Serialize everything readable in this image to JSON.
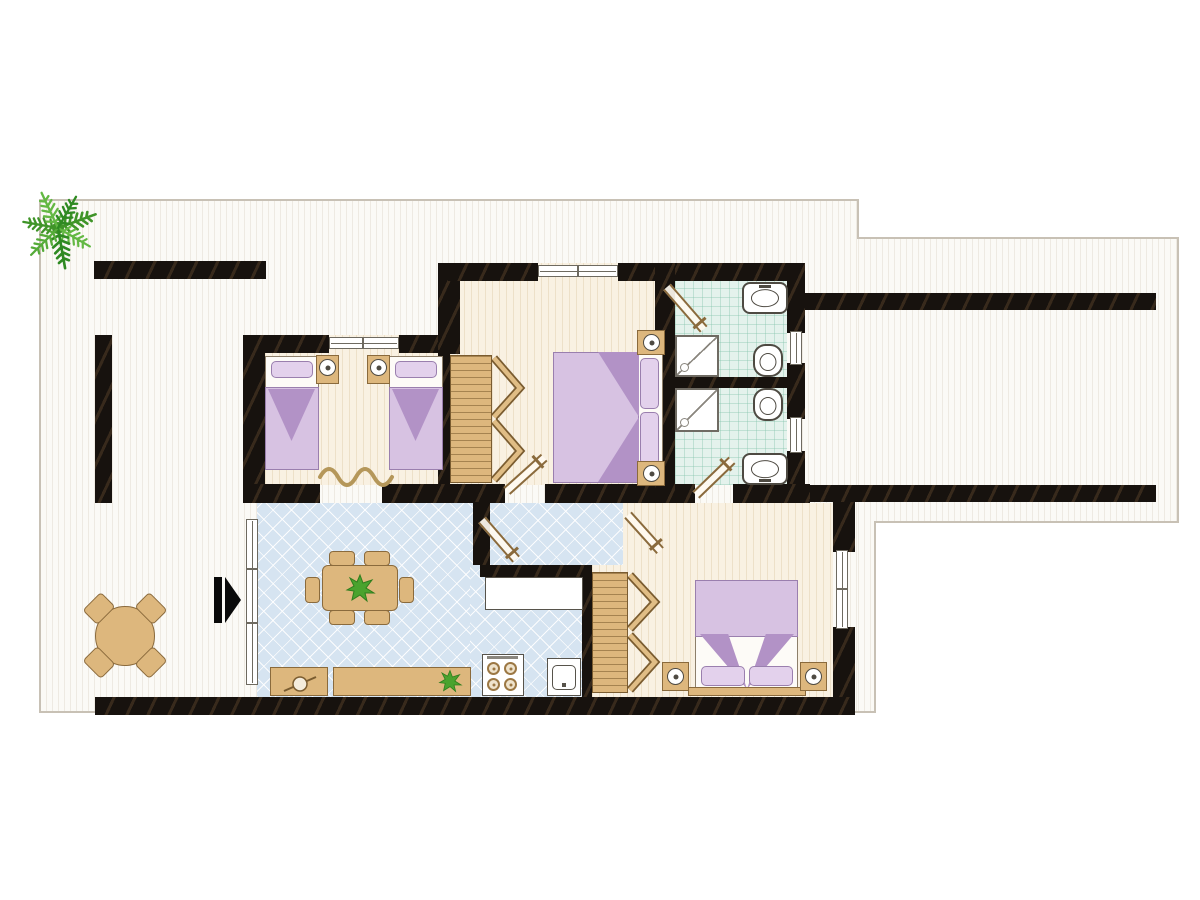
{
  "document": {
    "kind": "apartment floor plan drawing",
    "visible_text": "none",
    "orientation": "top-down plan view"
  },
  "colors": {
    "wall": "#17120e",
    "boundary_line": "#c8c1b5",
    "terrace_floor": "#fbfaf6",
    "bedroom_floor": "#f9f1e2",
    "living_floor": "#d6e4f1",
    "bath_floor": "#e4f2ec",
    "wood": "#ddb77d",
    "wood_dark": "#8a6a3c",
    "linen": "#d7c2e2",
    "linen_dark": "#b292c6",
    "plant_green": "#4aa32e",
    "plant_green_dark": "#2f8a22",
    "fixture_outline": "#4e4a42"
  },
  "rooms": [
    {
      "name": "terrace-left",
      "floor": "striped-white",
      "contents": [
        "ornamental tree",
        "round table",
        "4 chairs",
        "entrance arrow marker"
      ]
    },
    {
      "name": "twin-bedroom",
      "floor": "cream",
      "contents": [
        "single bed x2",
        "nightstand with lamp x2",
        "wavy rug",
        "window"
      ]
    },
    {
      "name": "master-bedroom",
      "floor": "cream",
      "contents": [
        "double bed",
        "nightstand with lamp x2",
        "wardrobe with open doors",
        "window"
      ]
    },
    {
      "name": "bathroom-upper",
      "floor": "mint-tile",
      "contents": [
        "washbasin",
        "toilet",
        "shower stall",
        "window",
        "door"
      ]
    },
    {
      "name": "bathroom-lower",
      "floor": "mint-tile",
      "contents": [
        "toilet",
        "washbasin",
        "shower stall",
        "window",
        "door"
      ]
    },
    {
      "name": "living-dining-room",
      "floor": "blue-lattice",
      "contents": [
        "dining table with plant",
        "6 chairs",
        "sideboard x2",
        "tall window"
      ]
    },
    {
      "name": "kitchen",
      "floor": "blue-lattice",
      "contents": [
        "counter",
        "stove 4 burners",
        "sink unit"
      ]
    },
    {
      "name": "hallway",
      "floor": "blue-lattice",
      "contents": [
        "door leaves"
      ]
    },
    {
      "name": "bedroom-rear",
      "floor": "cream",
      "contents": [
        "double bed",
        "nightstand with lamp x2",
        "wardrobe with open doors",
        "window"
      ]
    },
    {
      "name": "side-wing-terrace",
      "floor": "striped-white",
      "contents": []
    }
  ],
  "symbols": {
    "wall": "solid black band",
    "window": "white double-line strip",
    "door": "angled double-line leaf with handle tick",
    "entrance": "black arrow pointing right"
  }
}
